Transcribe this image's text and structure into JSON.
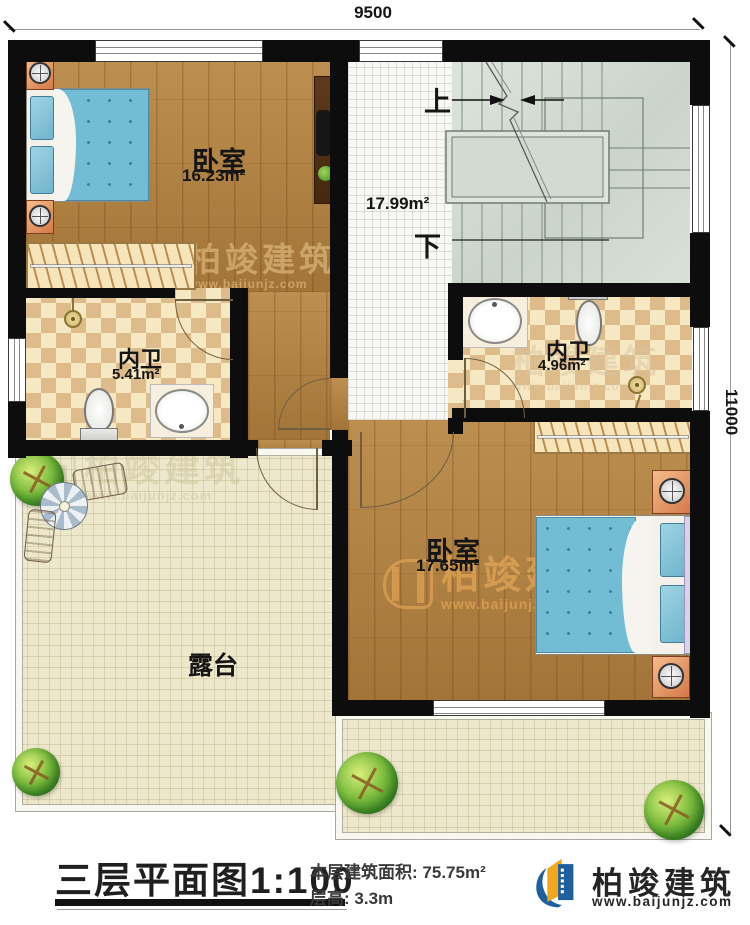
{
  "dimensions": {
    "top": "9500",
    "right": "11000"
  },
  "rooms": {
    "bedroom1": {
      "name": "卧室",
      "area": "16.23m²"
    },
    "hall": {
      "area": "17.99m²"
    },
    "bath1": {
      "name": "内卫",
      "area": "5.41m²"
    },
    "bath2": {
      "name": "内卫",
      "area": "4.96m²"
    },
    "bedroom2": {
      "name": "卧室",
      "area": "17.65m²"
    },
    "terrace": {
      "name": "露台"
    }
  },
  "stairs": {
    "up_label": "上",
    "down_label": "下"
  },
  "title_block": {
    "title": "三层平面图1:100",
    "floor_area_label": "本层建筑面积:",
    "floor_area_value": "75.75m²",
    "story_height_label": "层高:",
    "story_height_value": "3.3m"
  },
  "brand": {
    "name": "柏竣建筑",
    "website": "www.baijunjz.com"
  },
  "colors": {
    "wall": "#0d0d0d",
    "wood": "#b1803f",
    "checker_dark": "#debb8b",
    "checker_light": "#f6e8c2",
    "stair": "#d3dcd3",
    "terrace": "#ede8cb",
    "bed_blue": "#72bcd4",
    "logo_blue": "#1e5f9e",
    "logo_orange": "#f2a71f"
  }
}
